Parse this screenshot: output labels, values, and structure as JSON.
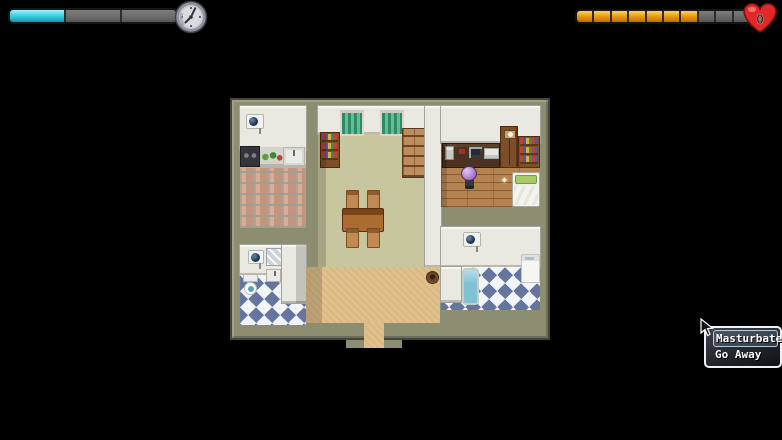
{
  "hud": {
    "time_gauge": {
      "icon": "clock-icon",
      "segments": 3,
      "filled": 1,
      "fill_color": "#3fd4e8",
      "fill_top": "#a8f0f8",
      "fill_bottom": "#1694b4",
      "empty_color": "#6b6b6b"
    },
    "affection_gauge": {
      "icon": "heart-icon",
      "segments": 10,
      "filled": 7,
      "fill_color": "#ef9d14",
      "fill_top": "#ffd468",
      "fill_bottom": "#b96d06",
      "empty_color": "#686868",
      "heart_label": "0"
    }
  },
  "map": {
    "rooms": [
      "kitchen",
      "dining-room",
      "bedroom-office",
      "bathroom-small",
      "bathroom-bath",
      "hallway"
    ],
    "objects": [
      "air-conditioner",
      "kitchen-stove",
      "kitchen-counter-food",
      "kitchen-sink",
      "window-curtain",
      "bookshelf",
      "storage-crates",
      "dining-table",
      "chair",
      "desk-with-computer",
      "wardrobe",
      "bed",
      "sparkle",
      "player-character",
      "toilet",
      "mirror",
      "wash-basin",
      "bathtub",
      "washing-machine",
      "clay-pot"
    ]
  },
  "choice_menu": {
    "options": [
      {
        "label": "Masturbate",
        "selected": true
      },
      {
        "label": "Go Away",
        "selected": false
      }
    ]
  },
  "colors": {
    "background": "#000000",
    "wall_outer": "#8d8d72",
    "wall_inner": "#e9e8e1",
    "floor_dining": "#c8c69e",
    "floor_hall": "#e0c08b",
    "floor_wood": "#b5834f",
    "checker_blue": "#65759f",
    "menu_border": "#eef2f4"
  }
}
